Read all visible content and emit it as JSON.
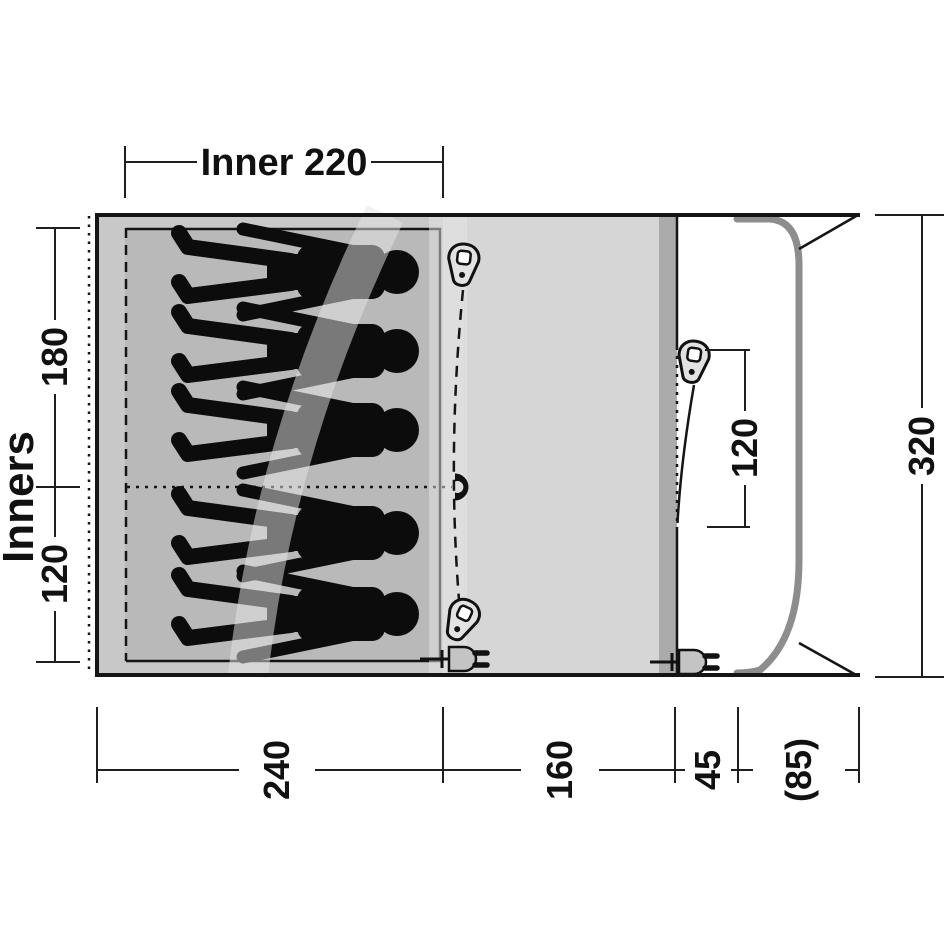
{
  "diagram": {
    "type": "tent-floorplan-top-view",
    "labels": {
      "inner_width": "Inner 220",
      "inners": "Inners",
      "bedroom_depth_top": "180",
      "bedroom_depth_bottom": "120",
      "side_door_width": "120",
      "total_depth": "320",
      "bottom_bedroom": "240",
      "bottom_living": "160",
      "bottom_front": "45",
      "bottom_canopy": "(85)"
    },
    "icons": {
      "zipper_pull": "zipper-pull-icon",
      "magnet": "magnet-closure-icon",
      "power_plug": "power-plug-icon",
      "person": "sleeping-person-silhouette"
    },
    "counts": {
      "sleeping_figures": 5,
      "zipper_pulls": 3,
      "power_plugs": 2
    },
    "colors": {
      "inner_tent": "#b9b9b9",
      "bedroom_zone": "#c8c8c8",
      "living_zone": "#d6d6d6",
      "front_wall_strip": "#ababab",
      "porch": "#ffffff",
      "pole": "#8d8d8d",
      "pole_band": "rgba(230,230,230,0.5)",
      "outline": "#151515"
    }
  }
}
